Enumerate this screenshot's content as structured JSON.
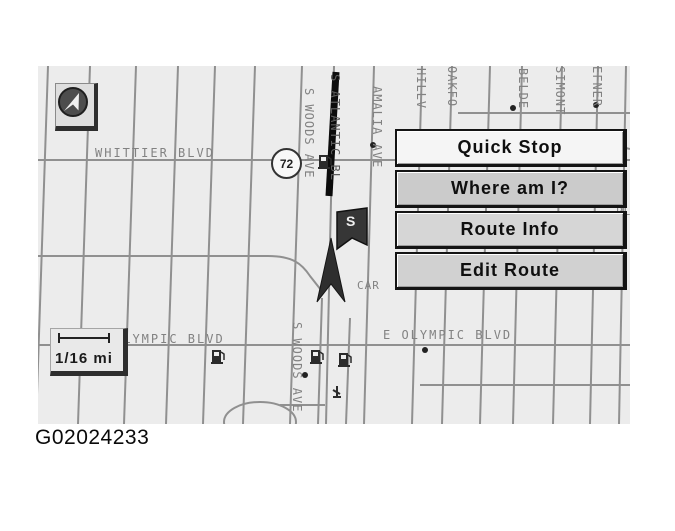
{
  "figure_id": "G02024233",
  "map": {
    "route_shield": "72",
    "destination_marker": "S",
    "scale": {
      "label": "1/16 mi"
    },
    "icons": {
      "compass": "north-arrow-icon",
      "fuel": "fuel-pump-icon",
      "destination": "destination-flag-icon",
      "vehicle": "vehicle-arrow-icon",
      "poi": "poi-icon",
      "scale_bar": "scale-bar-icon"
    },
    "streets": {
      "horizontal": [
        {
          "id": "whittier",
          "label": "WHITTIER BLVD"
        },
        {
          "id": "olympic-west",
          "label": "OLYMPIC BLVD"
        },
        {
          "id": "olympic-east",
          "label": "E OLYMPIC BLVD"
        },
        {
          "id": "car-fragment",
          "label": "CAR"
        },
        {
          "id": "pl-fragment",
          "label": "PL"
        }
      ],
      "vertical": [
        {
          "id": "s-woods-upper",
          "label": "S WOODS AVE"
        },
        {
          "id": "s-atlantic",
          "label": "S ATLANTIC BL"
        },
        {
          "id": "amalia",
          "label": "AMALIA AVE"
        },
        {
          "id": "hillview",
          "label": "HILLV"
        },
        {
          "id": "oakford",
          "label": "OAKFO"
        },
        {
          "id": "belden",
          "label": "BELDE"
        },
        {
          "id": "simont",
          "label": "SIMONT"
        },
        {
          "id": "hefner",
          "label": "EFNER"
        },
        {
          "id": "s-woods-lower",
          "label": "S WOODS AVE"
        }
      ]
    }
  },
  "menu": {
    "items": [
      {
        "label": "Quick Stop"
      },
      {
        "label": "Where am I?"
      },
      {
        "label": "Route Info"
      },
      {
        "label": "Edit Route"
      }
    ]
  }
}
